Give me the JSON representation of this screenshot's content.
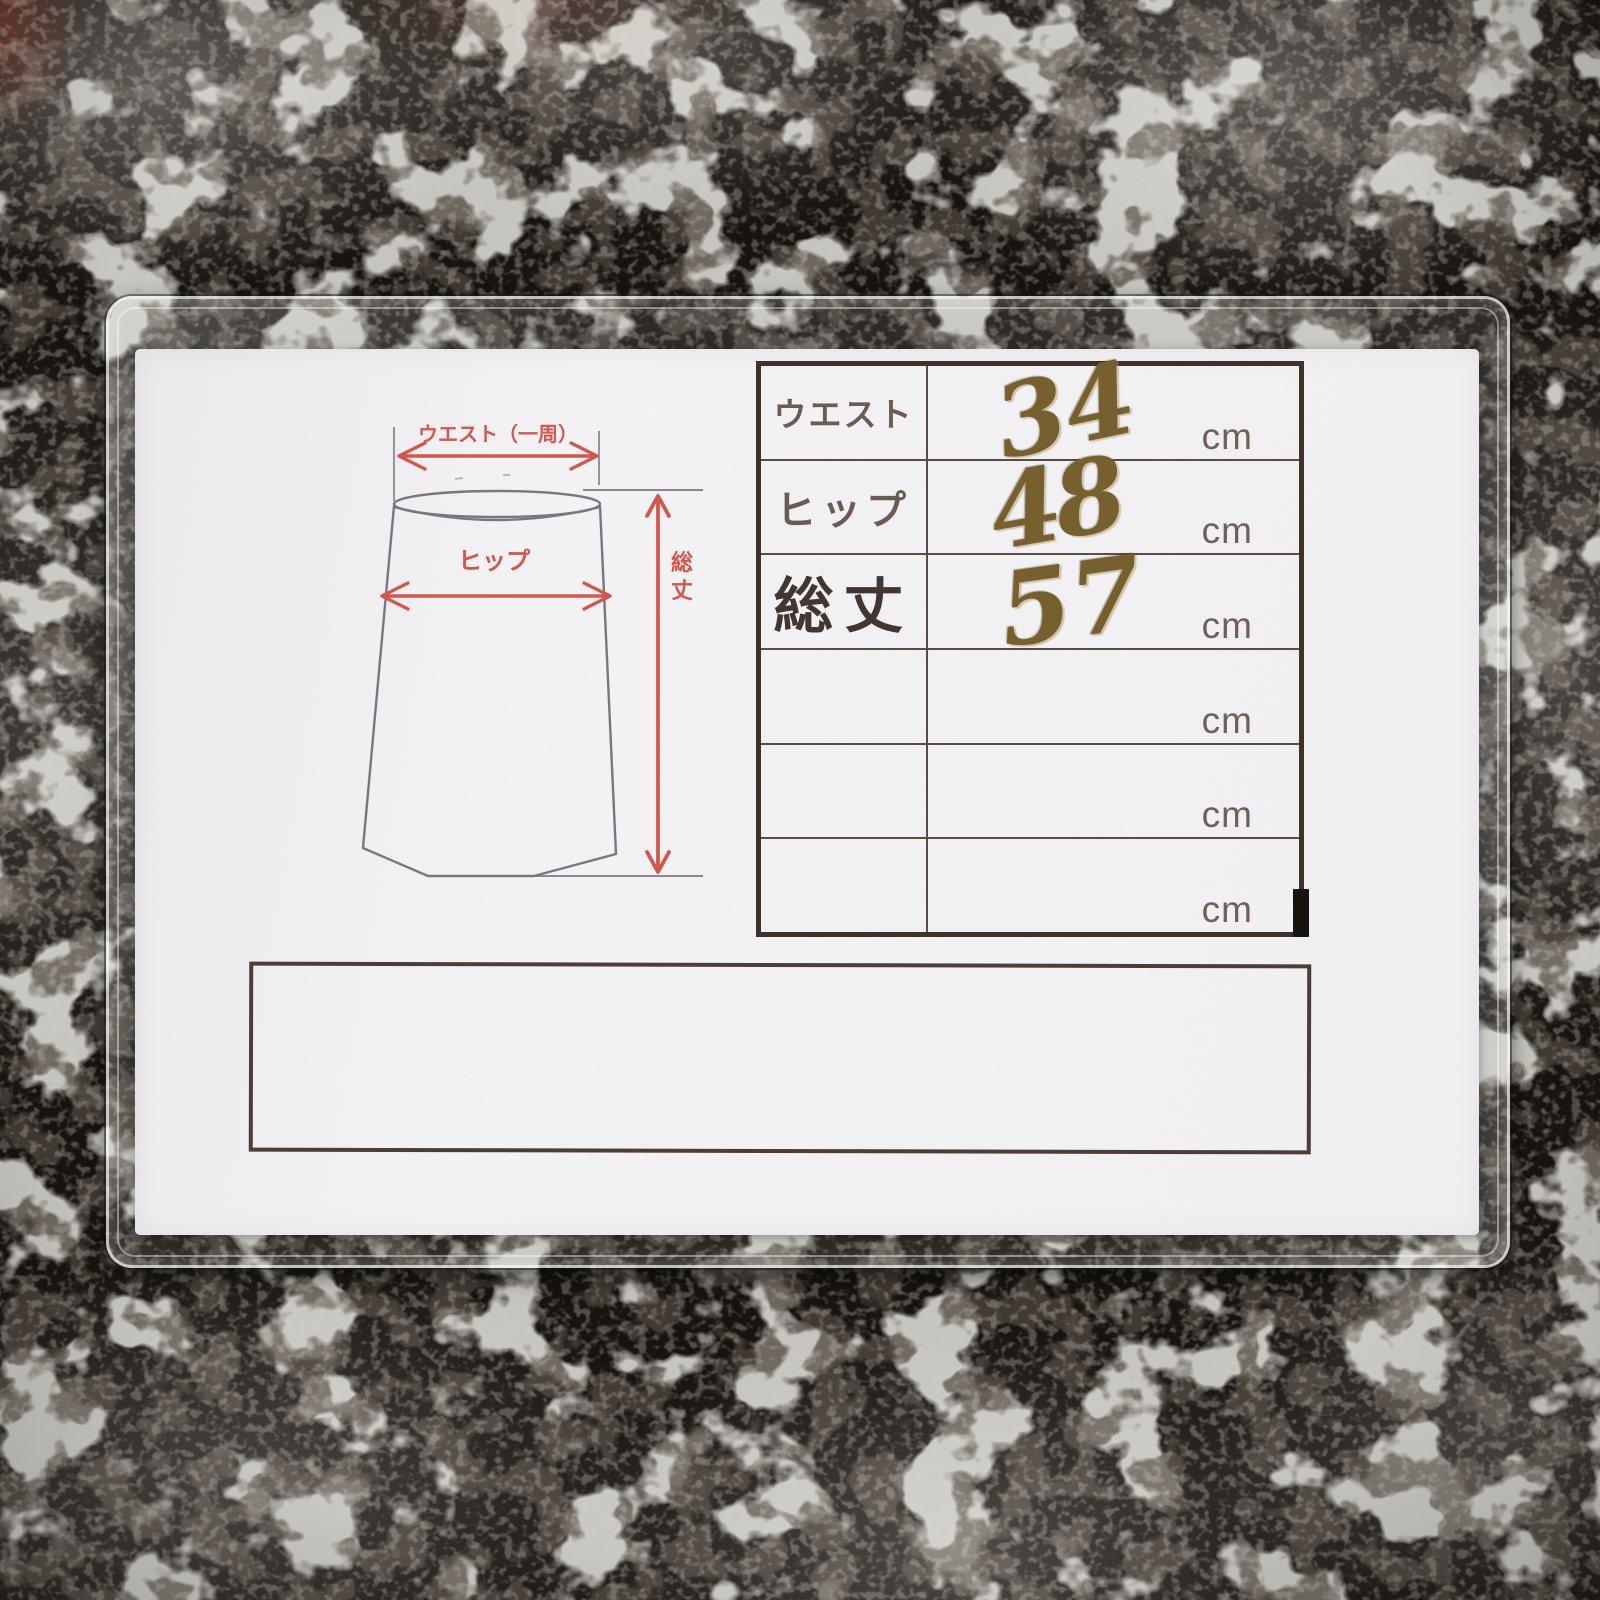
{
  "diagram": {
    "waist_label": "ウエスト（一周）",
    "hip_label": "ヒップ",
    "length_label_top": "総",
    "length_label_bottom": "丈"
  },
  "table": {
    "rows": [
      {
        "label": "ウエスト",
        "value": "34",
        "unit": "cm"
      },
      {
        "label": "ヒップ",
        "value": "48",
        "unit": "cm"
      },
      {
        "label": "総丈",
        "value": "57",
        "unit": "cm"
      },
      {
        "label": "",
        "value": "",
        "unit": "cm"
      },
      {
        "label": "",
        "value": "",
        "unit": "cm"
      },
      {
        "label": "",
        "value": "",
        "unit": "cm"
      }
    ]
  },
  "colors": {
    "accent-red": "#d2574d",
    "ink-brown": "#76602f",
    "table-border": "#413229",
    "table-line": "#5d4a41",
    "label-color": "#6b5b50",
    "heavy-label-color": "#433630",
    "unit-color": "#6f6156",
    "paper-color": "#f2f1f3",
    "sketch-gray": "#7b7580",
    "guide-gray": "#8d8890",
    "fabric-dark": "#17130f"
  }
}
